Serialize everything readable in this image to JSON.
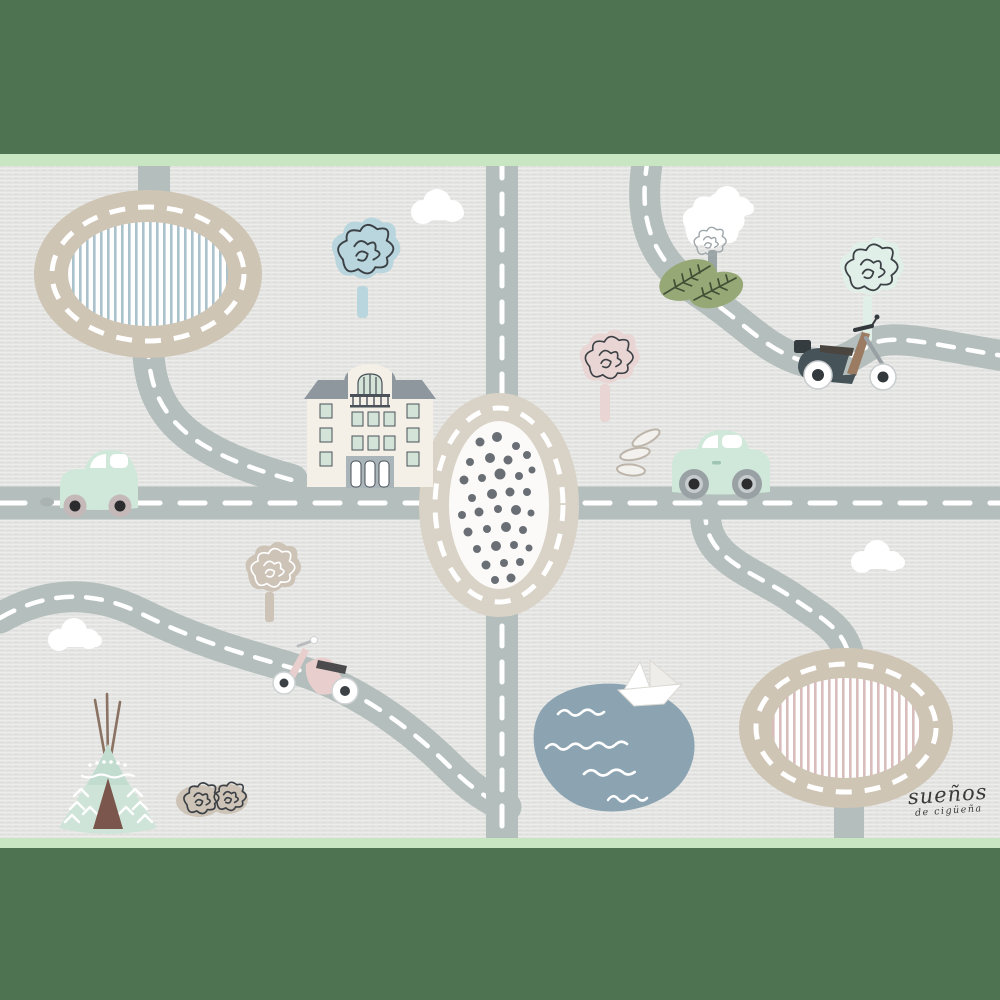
{
  "scene": {
    "type": "children-road-playmat-illustration",
    "signature": {
      "line1": "sueños",
      "line2": "de cigüeña"
    },
    "palette": {
      "green_border": "#4e7350",
      "mint_edge": "#c9e6c2",
      "mat_bg": "#e4e4e2",
      "road": "#b4bfbd",
      "road_dash": "#ffffff",
      "ring_beige": "#cfc5b5",
      "ring_beige_light": "#d9d2c6",
      "oval_inner": "#fbfaf8",
      "stripe_blue": "#a9c2cb",
      "stripe_pink": "#d9bcbc",
      "dot_grey": "#696f75",
      "mint": "#cfe8da",
      "window_white": "#ffffff",
      "wheel_pink": "#c5b8b8",
      "wheel_grey": "#9aa1a5",
      "wheel_dark": "#2c2c2e",
      "pond_blue": "#8ca4b2",
      "cloud_white": "#ffffff",
      "building_wall": "#f4efe7",
      "building_roof": "#8e979e",
      "window_green": "#d3e3d8",
      "entry_grey": "#aab5b9",
      "frame_dark": "#4a5158",
      "tree_blue": "#b9d5dd",
      "tree_pink": "#e9d6d4",
      "tree_beige": "#cdc3b7",
      "tree_mint_pale": "#e0efe7",
      "leaf_green": "#97a877",
      "leaf_vein": "#414f35",
      "scribble_dark": "#3c4146",
      "trunk_grey": "#9aa4a6",
      "teepee_mint": "#cfe4d8",
      "teepee_cap": "#c2dccf",
      "door_brown": "#7a564c",
      "pole_brown": "#8b7364",
      "scooter_teal": "#46545a",
      "scooter_brown": "#9b7b62",
      "seat_dark": "#4b4540",
      "scooter_pink": "#e8cfcd",
      "swoosh_line": "#bdb5aa",
      "signature_ink": "#3a3a3a"
    },
    "elements": [
      "striped-roundabout-blue",
      "dotted-roundabout",
      "striped-roundabout-pink",
      "horizontal-road",
      "vertical-road",
      "curvy-road-top-right",
      "curvy-road-bottom-left",
      "curvy-road-bottom-right",
      "apartment-building",
      "mint-car-left",
      "mint-car-right",
      "teal-scooter",
      "pink-scooter",
      "teepee-tent",
      "pond",
      "paper-boat",
      "scribble-bush",
      "tree-blue",
      "tree-white-green",
      "tree-pale-mint",
      "tree-pink",
      "tree-beige",
      "cloud-top-center",
      "cloud-top-right",
      "cloud-mid-right",
      "cloud-bottom-left"
    ]
  }
}
